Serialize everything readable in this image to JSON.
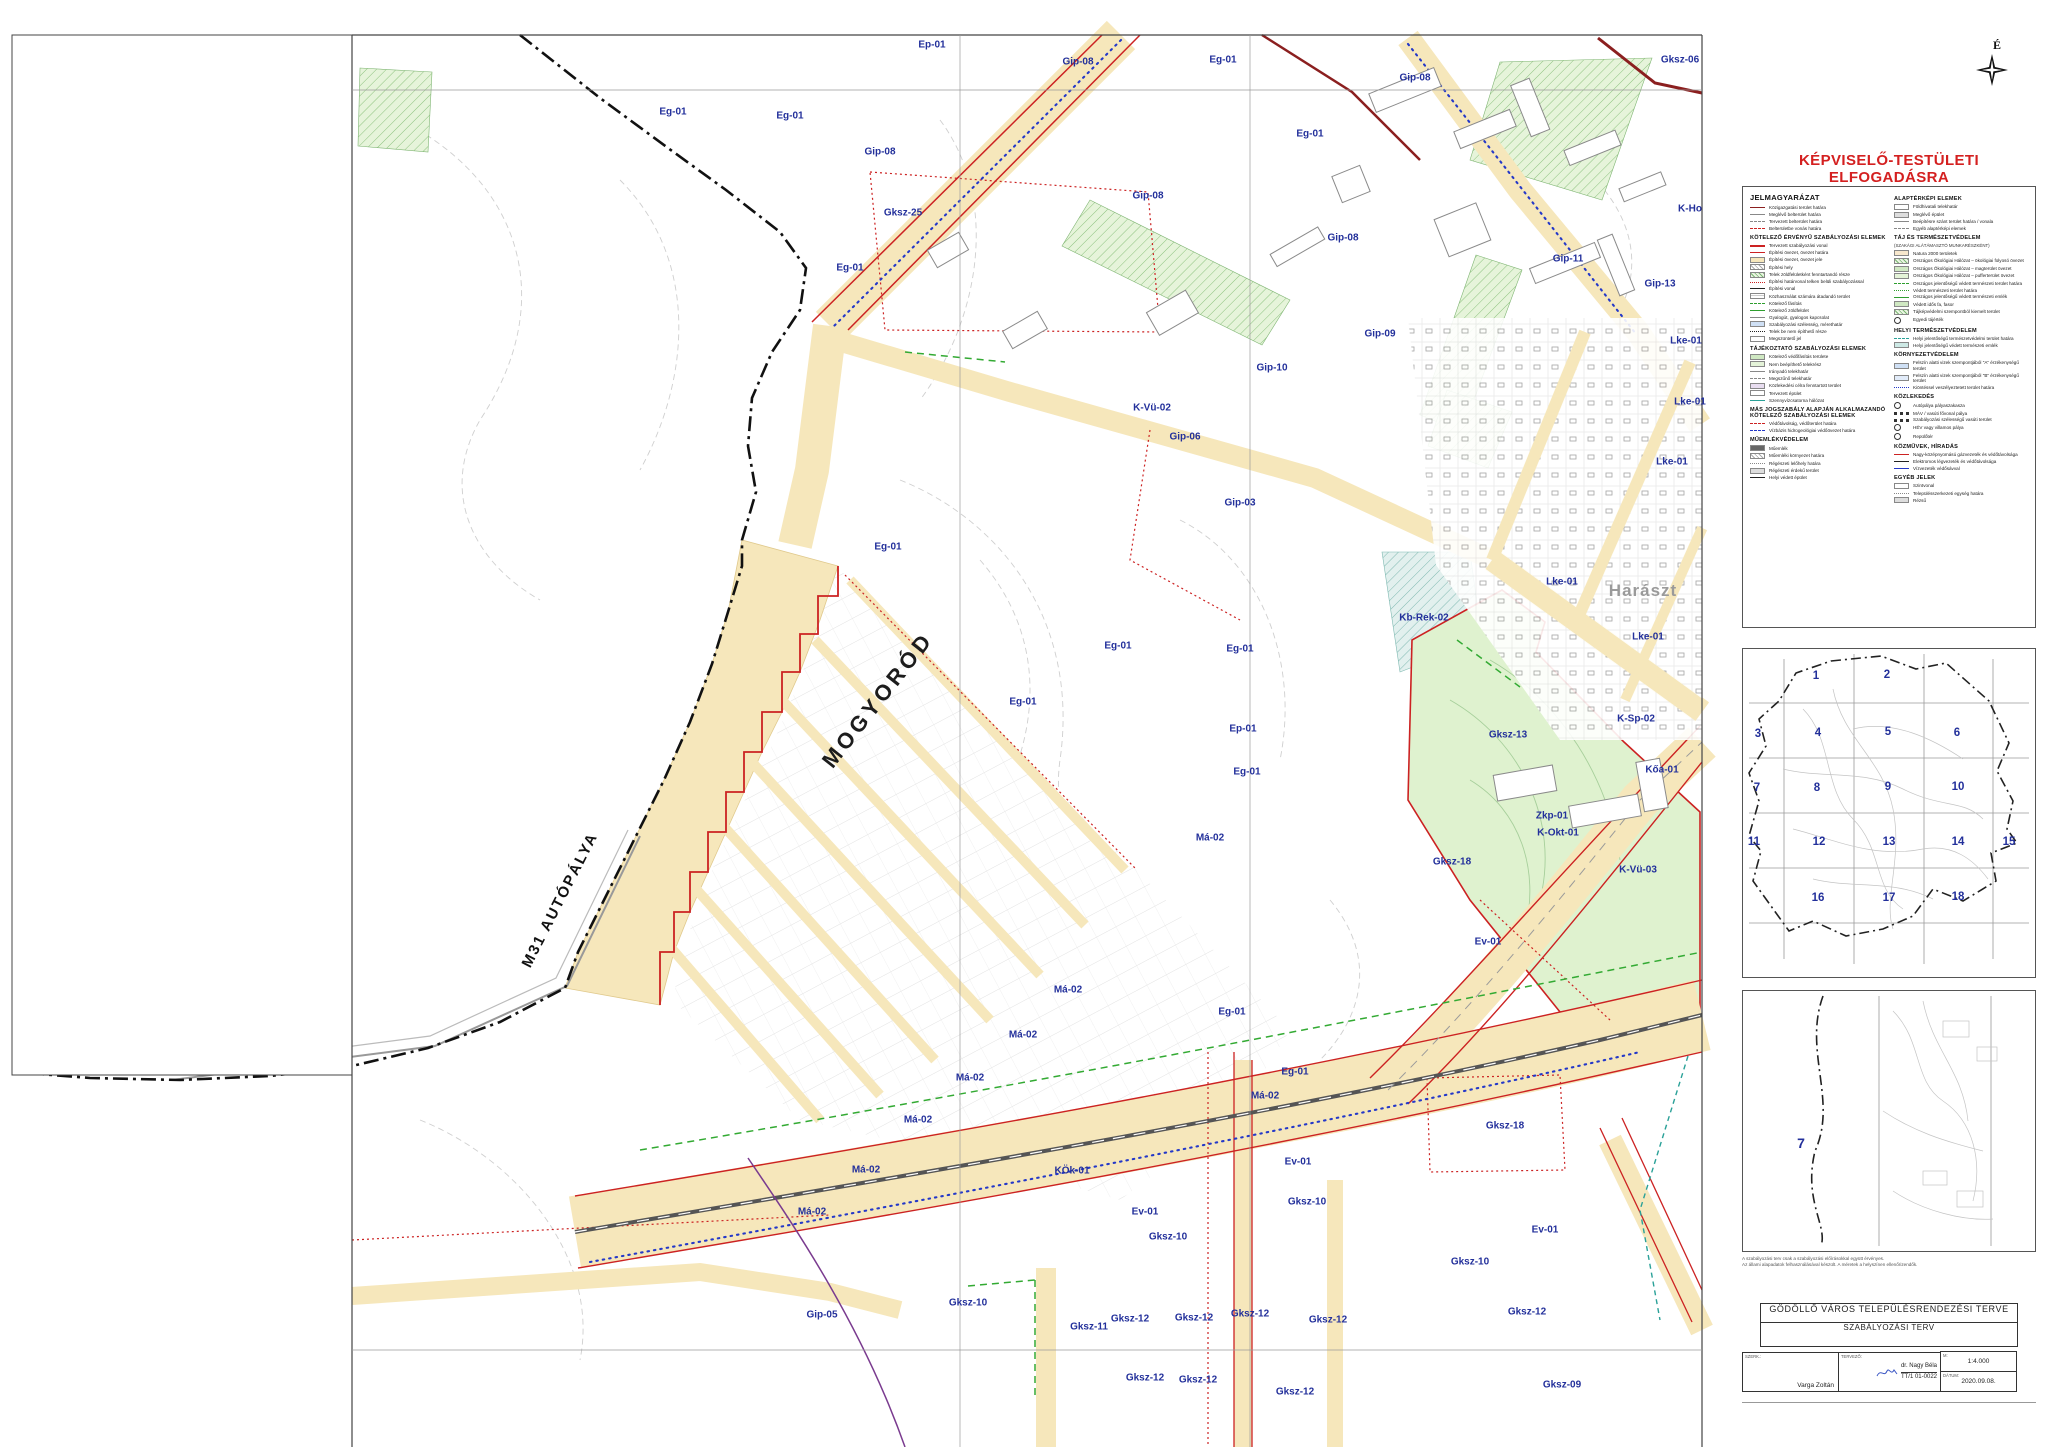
{
  "approval": {
    "text": "KÉPVISELŐ-TESTÜLETI ELFOGADÁSRA"
  },
  "north": {
    "label": "É"
  },
  "map": {
    "labels": [
      {
        "t": "Ep-01",
        "x": 932,
        "y": 45
      },
      {
        "t": "Gip-08",
        "x": 1078,
        "y": 62
      },
      {
        "t": "Eg-01",
        "x": 673,
        "y": 112
      },
      {
        "t": "Eg-01",
        "x": 790,
        "y": 116
      },
      {
        "t": "Gip-08",
        "x": 880,
        "y": 152
      },
      {
        "t": "Eg-01",
        "x": 1223,
        "y": 60
      },
      {
        "t": "Gksz-06",
        "x": 1680,
        "y": 60
      },
      {
        "t": "Eg-01",
        "x": 1310,
        "y": 134
      },
      {
        "t": "Gip-08",
        "x": 1415,
        "y": 78
      },
      {
        "t": "Gksz-25",
        "x": 903,
        "y": 213
      },
      {
        "t": "Eg-01",
        "x": 850,
        "y": 268
      },
      {
        "t": "Gip-08",
        "x": 1148,
        "y": 196
      },
      {
        "t": "Gip-08",
        "x": 1343,
        "y": 238
      },
      {
        "t": "K-Ho",
        "x": 1690,
        "y": 209
      },
      {
        "t": "Gip-11",
        "x": 1568,
        "y": 259
      },
      {
        "t": "Gip-13",
        "x": 1660,
        "y": 284
      },
      {
        "t": "Lke-01",
        "x": 1686,
        "y": 341
      },
      {
        "t": "Lke-01",
        "x": 1690,
        "y": 402
      },
      {
        "t": "Gip-09",
        "x": 1380,
        "y": 334
      },
      {
        "t": "Gip-10",
        "x": 1272,
        "y": 368
      },
      {
        "t": "K-Vü-02",
        "x": 1152,
        "y": 408
      },
      {
        "t": "Gip-06",
        "x": 1185,
        "y": 437
      },
      {
        "t": "Gip-03",
        "x": 1240,
        "y": 503
      },
      {
        "t": "Lke-01",
        "x": 1672,
        "y": 462
      },
      {
        "t": "Eg-01",
        "x": 888,
        "y": 547
      },
      {
        "t": "Eg-01",
        "x": 1118,
        "y": 646
      },
      {
        "t": "Eg-01",
        "x": 1240,
        "y": 649
      },
      {
        "t": "Kb-Rek-02",
        "x": 1424,
        "y": 618
      },
      {
        "t": "Lke-01",
        "x": 1562,
        "y": 582
      },
      {
        "t": "Harászt",
        "x": 1643,
        "y": 591,
        "c": "place"
      },
      {
        "t": "Lke-01",
        "x": 1648,
        "y": 637
      },
      {
        "t": "K-Sp-02",
        "x": 1636,
        "y": 719
      },
      {
        "t": "Zkp-01",
        "x": 1552,
        "y": 816
      },
      {
        "t": "Eg-01",
        "x": 1023,
        "y": 702
      },
      {
        "t": "Ep-01",
        "x": 1243,
        "y": 729
      },
      {
        "t": "Gksz-13",
        "x": 1508,
        "y": 735
      },
      {
        "t": "Eg-01",
        "x": 1247,
        "y": 772
      },
      {
        "t": "Kőa-01",
        "x": 1662,
        "y": 770
      },
      {
        "t": "Má-02",
        "x": 1210,
        "y": 838
      },
      {
        "t": "K-Okt-01",
        "x": 1558,
        "y": 833
      },
      {
        "t": "Gksz-18",
        "x": 1452,
        "y": 862
      },
      {
        "t": "K-Vü-03",
        "x": 1638,
        "y": 870
      },
      {
        "t": "Ev-01",
        "x": 1488,
        "y": 942
      },
      {
        "t": "Má-02",
        "x": 1068,
        "y": 990
      },
      {
        "t": "Má-02",
        "x": 1023,
        "y": 1035
      },
      {
        "t": "Má-02",
        "x": 970,
        "y": 1078
      },
      {
        "t": "Má-02",
        "x": 918,
        "y": 1120
      },
      {
        "t": "Má-02",
        "x": 866,
        "y": 1170
      },
      {
        "t": "Má-02",
        "x": 812,
        "y": 1212
      },
      {
        "t": "Eg-01",
        "x": 1232,
        "y": 1012
      },
      {
        "t": "Eg-01",
        "x": 1295,
        "y": 1072
      },
      {
        "t": "Má-02",
        "x": 1265,
        "y": 1096
      },
      {
        "t": "KÖk-01",
        "x": 1072,
        "y": 1171
      },
      {
        "t": "Ev-01",
        "x": 1298,
        "y": 1162
      },
      {
        "t": "Gksz-18",
        "x": 1505,
        "y": 1126
      },
      {
        "t": "Gksz-10",
        "x": 1307,
        "y": 1202
      },
      {
        "t": "Gksz-10",
        "x": 1168,
        "y": 1237
      },
      {
        "t": "Ev-01",
        "x": 1145,
        "y": 1212
      },
      {
        "t": "Ev-01",
        "x": 1545,
        "y": 1230
      },
      {
        "t": "Gksz-10",
        "x": 1470,
        "y": 1262
      },
      {
        "t": "Gip-05",
        "x": 822,
        "y": 1315
      },
      {
        "t": "Gksz-10",
        "x": 968,
        "y": 1303
      },
      {
        "t": "Gksz-11",
        "x": 1089,
        "y": 1327
      },
      {
        "t": "Gksz-12",
        "x": 1130,
        "y": 1319
      },
      {
        "t": "Gksz-12",
        "x": 1194,
        "y": 1318
      },
      {
        "t": "Gksz-12",
        "x": 1250,
        "y": 1314
      },
      {
        "t": "Gksz-12",
        "x": 1328,
        "y": 1320
      },
      {
        "t": "Gksz-12",
        "x": 1145,
        "y": 1378
      },
      {
        "t": "Gksz-12",
        "x": 1198,
        "y": 1380
      },
      {
        "t": "Gksz-12",
        "x": 1295,
        "y": 1392
      },
      {
        "t": "Gksz-12",
        "x": 1527,
        "y": 1312
      },
      {
        "t": "Gksz-09",
        "x": 1562,
        "y": 1385
      },
      {
        "t": "MOGYORÓD",
        "x": 878,
        "y": 700,
        "r": -52,
        "c": "muni"
      },
      {
        "t": "M31 AUTÓPÁLYA",
        "x": 560,
        "y": 900,
        "r": -63,
        "c": "roadname"
      }
    ]
  },
  "legend": {
    "title": "JELMAGYARÁZAT",
    "col1": [
      {
        "header": "",
        "items": [
          {
            "sw": "l darkred",
            "label": "Közigazgatási terület határa"
          },
          {
            "sw": "l gray",
            "label": "Meglévő belterület határa"
          },
          {
            "sw": "l gray dash",
            "label": "Tervezett belterület határa"
          },
          {
            "sw": "l red dash",
            "label": "Belterületbe vonás határa"
          }
        ]
      },
      {
        "header": "KÖTELEZŐ ÉRVÉNYŰ SZABÁLYOZÁSI ELEMEK",
        "items": [
          {
            "sw": "l red thick",
            "label": "Tervezett szabályozási vonal"
          },
          {
            "sw": "l red",
            "label": "Építési övezet, övezet határa"
          },
          {
            "sw": "b byellow",
            "label": "Építési övezet, övezet jele"
          },
          {
            "sw": "b bhatch",
            "label": "Építési hely"
          },
          {
            "sw": "b bhatchg",
            "label": "Telek zöldfelületként fenntartandó része"
          },
          {
            "sw": "l red dot",
            "label": "Építési határvonal telken belüli szabályozással"
          },
          {
            "sw": "l dark",
            "label": "Építési vonal"
          },
          {
            "sw": "b bgrid",
            "label": "Közhasználat számára átadandó terület"
          },
          {
            "sw": "l green dash",
            "label": "Kötelező fásítás"
          },
          {
            "sw": "l green",
            "label": "Kötelező zöldfelület"
          },
          {
            "sw": "l gray",
            "label": "Gyalogút, gyalogos kapcsolat"
          },
          {
            "sw": "b bblue",
            "label": "Szabályozási szélesség, mérethatár"
          },
          {
            "sw": "l dark dot",
            "label": "Telek be nem építhető része"
          },
          {
            "sw": "b",
            "label": "Megszüntető jel"
          }
        ]
      },
      {
        "header": "TÁJÉKOZTATÓ SZABÁLYOZÁSI ELEMEK",
        "items": [
          {
            "sw": "b bgreen",
            "label": "Kötelező védőfásítás területe"
          },
          {
            "sw": "b blgreen",
            "label": "Nem beépíthető telekrész"
          },
          {
            "sw": "l gray",
            "label": "Irányadó telekhatár"
          },
          {
            "sw": "l gray dash",
            "label": "Megszűnő telekhatár"
          },
          {
            "sw": "b blilac",
            "label": "Közlekedési célra fenntartott terület"
          },
          {
            "sw": "b",
            "label": "Tervezett épület"
          },
          {
            "sw": "l teal",
            "label": "Szennyvízcsatorna hálózat"
          }
        ]
      },
      {
        "header": "MÁS JOGSZABÁLY ALAPJÁN ALKALMAZANDÓ KÖTELEZŐ SZABÁLYOZÁSI ELEMEK",
        "items": [
          {
            "sw": "l red dash",
            "label": "Védőtávolság, védőterület határa"
          },
          {
            "sw": "l blue dash",
            "label": "Vízbázis hidrogeológiai védőövezet határa"
          }
        ]
      },
      {
        "header": "MŰEMLÉKVÉDELEM",
        "items": [
          {
            "sw": "b bdark",
            "label": "Műemlék"
          },
          {
            "sw": "b bhatch",
            "label": "Műemléki környezet határa"
          },
          {
            "sw": "l gray dot",
            "label": "Régészeti lelőhely határa"
          },
          {
            "sw": "b bgray",
            "label": "Régészeti érdekű terület"
          },
          {
            "sw": "l dark",
            "label": "Helyi védett épület"
          }
        ]
      }
    ],
    "col2": [
      {
        "header": "ALAPTÉRKÉPI ELEMEK",
        "items": [
          {
            "sw": "b",
            "label": "Földhivatali telekhatár"
          },
          {
            "sw": "b bgray",
            "label": "Meglévő épület"
          },
          {
            "sw": "l gray",
            "label": "Beépítésre szánt terület határa / vonala"
          },
          {
            "sw": "l gray dash",
            "label": "Egyéb alaptérképi elemek"
          }
        ]
      },
      {
        "header": "TÁJ ÉS TERMÉSZETVÉDELEM",
        "sub": "(SZAKÁGI ALÁTÁMASZTÓ MUNKARÉSZKÉNT)",
        "items": [
          {
            "sw": "b borange",
            "label": "Natura 2000 területek"
          },
          {
            "sw": "b bhatchg",
            "label": "Országos Ökológiai Hálózat – ökológiai folyosó övezet"
          },
          {
            "sw": "b bgreen",
            "label": "Országos Ökológiai Hálózat – magterület övezet"
          },
          {
            "sw": "b blgreen",
            "label": "Országos Ökológiai Hálózat – pufferterület övezet"
          },
          {
            "sw": "l green dash",
            "label": "Országos jelentőségű védett természeti terület határa"
          },
          {
            "sw": "l green dot",
            "label": "Védett természeti terület határa"
          },
          {
            "sw": "l green",
            "label": "Országos jelentőségű védett természeti emlék"
          },
          {
            "sw": "b bgreen",
            "label": "Védett idős fa, fasor"
          },
          {
            "sw": "b bhatchg",
            "label": "Tájképvédelmi szempontból kiemelt terület"
          },
          {
            "sw": "b round green",
            "label": "Egyedi tájérték"
          }
        ]
      },
      {
        "header": "HELYI TERMÉSZETVÉDELEM",
        "items": [
          {
            "sw": "l teal dash",
            "label": "Helyi jelentőségű természetvédelmi terület határa"
          },
          {
            "sw": "b bteal",
            "label": "Helyi jelentőségű védett természeti emlék"
          }
        ]
      },
      {
        "header": "KÖRNYEZETVÉDELEM",
        "items": [
          {
            "sw": "b bblue",
            "label": "Felszín alatti vizek szempontjából \"A\" érzékenységű terület"
          },
          {
            "sw": "b bblue2",
            "label": "Felszín alatti vizek szempontjából \"B\" érzékenységű terület"
          },
          {
            "sw": "l blue dot",
            "label": "Kiöntéssel veszélyeztetett terület határa"
          }
        ]
      },
      {
        "header": "KÖZLEKEDÉS",
        "items": [
          {
            "sw": "b round",
            "label": "Autópálya pályaszakasza"
          },
          {
            "sw": "rail",
            "label": "MÁV / vasúti fővonal pálya"
          },
          {
            "sw": "rail",
            "label": "Szabályozási szélességű vasúti terület"
          },
          {
            "sw": "b round",
            "label": "HÉV vagy villamos pálya"
          },
          {
            "sw": "b round",
            "label": "Repülőtér"
          }
        ]
      },
      {
        "header": "KÖZMŰVEK, HÍRADÁS",
        "items": [
          {
            "sw": "l red",
            "label": "Nagy-középnyomású gázvezeték és védőtávolsága"
          },
          {
            "sw": "l dark",
            "label": "Elektromos légvezeték és védőtávolsága"
          },
          {
            "sw": "l blue",
            "label": "Vízvezeték védősávval"
          }
        ]
      },
      {
        "header": "EGYÉB JELEK",
        "items": [
          {
            "sw": "b",
            "label": "Szintvonal"
          },
          {
            "sw": "l gray dot",
            "label": "Településszerkezeti egység határa"
          },
          {
            "sw": "b bgray",
            "label": "Rézsű"
          }
        ]
      }
    ]
  },
  "insets": {
    "overview": {
      "numbers": [
        {
          "n": "1",
          "x": 1815,
          "y": 675
        },
        {
          "n": "2",
          "x": 1886,
          "y": 674
        },
        {
          "n": "3",
          "x": 1757,
          "y": 733
        },
        {
          "n": "4",
          "x": 1817,
          "y": 732
        },
        {
          "n": "5",
          "x": 1887,
          "y": 731
        },
        {
          "n": "6",
          "x": 1956,
          "y": 732
        },
        {
          "n": "7",
          "x": 1756,
          "y": 787
        },
        {
          "n": "8",
          "x": 1816,
          "y": 787
        },
        {
          "n": "9",
          "x": 1887,
          "y": 786
        },
        {
          "n": "10",
          "x": 1957,
          "y": 786
        },
        {
          "n": "11",
          "x": 1753,
          "y": 841
        },
        {
          "n": "12",
          "x": 1818,
          "y": 841
        },
        {
          "n": "13",
          "x": 1888,
          "y": 841
        },
        {
          "n": "14",
          "x": 1957,
          "y": 841
        },
        {
          "n": "15",
          "x": 2008,
          "y": 841
        },
        {
          "n": "16",
          "x": 1817,
          "y": 897
        },
        {
          "n": "17",
          "x": 1888,
          "y": 897
        },
        {
          "n": "18",
          "x": 1957,
          "y": 896
        }
      ]
    },
    "detail": {
      "sheet_number": "7"
    }
  },
  "note": {
    "line1": "A szabályozási terv csak a szabályozási előírásokkal együtt érvényes.",
    "line2": "Az állami alapadatok felhasználásával készült. A méretek a helyszínen ellenőrizendők."
  },
  "title_block": {
    "line1": "GÖDÖLLŐ VÁROS TELEPÜLÉSRENDEZÉSI TERVE",
    "line2": "SZABÁLYOZÁSI TERV",
    "drafter_label": "SZERK.:",
    "drafter": "Varga Zoltán",
    "planner_label": "TERVEZŐ:",
    "planner": "dr. Nagy Béla",
    "planner_id": "TT/1 01-0022",
    "scale_label": "M:",
    "scale": "1:4.000",
    "date_label": "DÁTUM:",
    "date": "2020.09.08."
  }
}
